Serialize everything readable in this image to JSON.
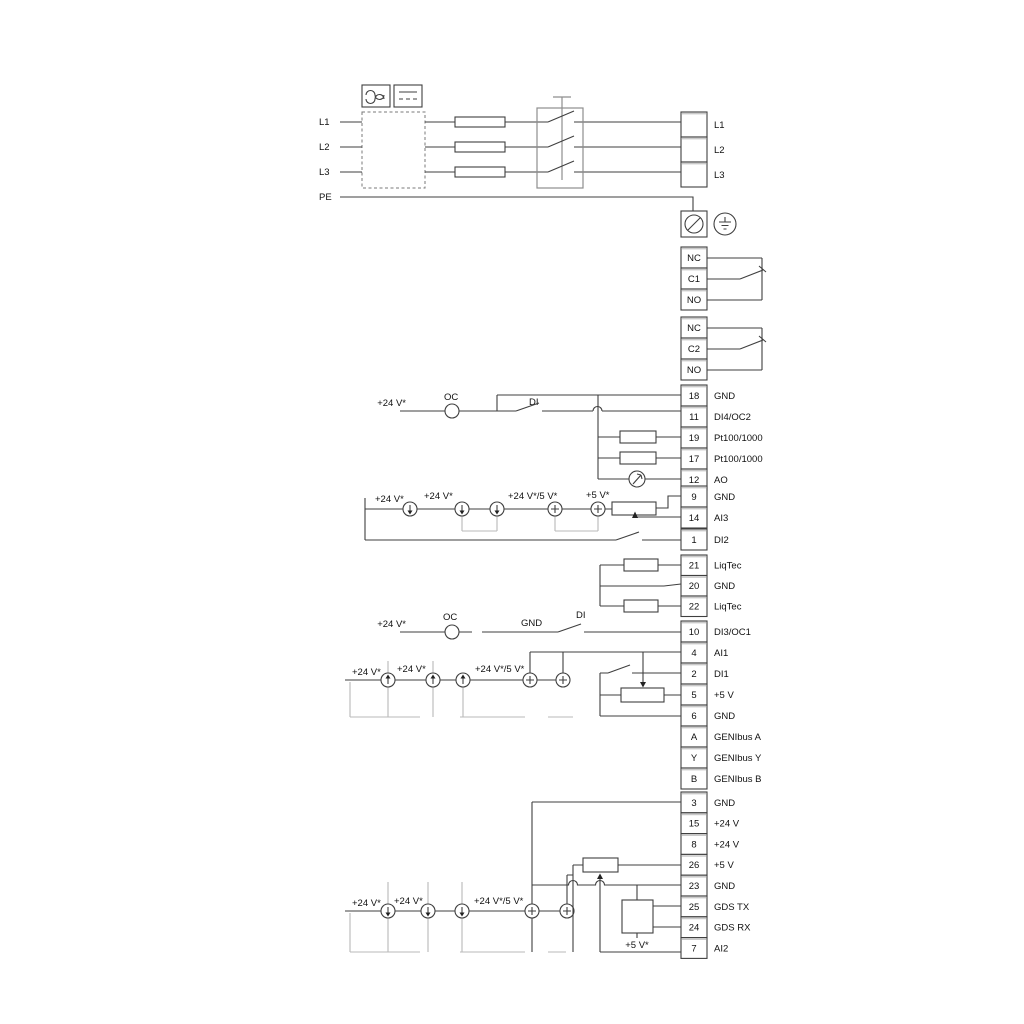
{
  "mains_in": {
    "l1": "L1",
    "l2": "L2",
    "l3": "L3",
    "pe": "PE"
  },
  "inline": {
    "v24": "+24 V*",
    "v24v5": "+24 V*/5 V*",
    "v5": "+5 V*",
    "oc": "OC",
    "di": "DI",
    "gnd": "GND"
  },
  "strips": {
    "mains_out": {
      "rows": [
        {
          "num": "",
          "label": "L1"
        },
        {
          "num": "",
          "label": "L2"
        },
        {
          "num": "",
          "label": "L3"
        }
      ]
    },
    "relay1": {
      "rows": [
        {
          "num": "NC",
          "label": ""
        },
        {
          "num": "C1",
          "label": ""
        },
        {
          "num": "NO",
          "label": ""
        }
      ]
    },
    "relay2": {
      "rows": [
        {
          "num": "NC",
          "label": ""
        },
        {
          "num": "C2",
          "label": ""
        },
        {
          "num": "NO",
          "label": ""
        }
      ]
    },
    "io_a": {
      "rows": [
        {
          "num": "18",
          "label": "GND"
        },
        {
          "num": "11",
          "label": "DI4/OC2"
        },
        {
          "num": "19",
          "label": "Pt100/1000"
        },
        {
          "num": "17",
          "label": "Pt100/1000"
        },
        {
          "num": "12",
          "label": "AO"
        }
      ]
    },
    "io_b": {
      "rows": [
        {
          "num": "9",
          "label": "GND"
        },
        {
          "num": "14",
          "label": "AI3"
        }
      ]
    },
    "io_c": {
      "rows": [
        {
          "num": "1",
          "label": "DI2"
        }
      ]
    },
    "liqtec": {
      "rows": [
        {
          "num": "21",
          "label": "LiqTec"
        },
        {
          "num": "20",
          "label": "GND"
        },
        {
          "num": "22",
          "label": "LiqTec"
        }
      ]
    },
    "di3": {
      "rows": [
        {
          "num": "10",
          "label": "DI3/OC1"
        }
      ]
    },
    "io_d": {
      "rows": [
        {
          "num": "4",
          "label": "AI1"
        },
        {
          "num": "2",
          "label": "DI1"
        },
        {
          "num": "5",
          "label": "+5 V"
        },
        {
          "num": "6",
          "label": "GND"
        },
        {
          "num": "A",
          "label": "GENIbus A"
        },
        {
          "num": "Y",
          "label": "GENIbus Y"
        },
        {
          "num": "B",
          "label": "GENIbus B"
        }
      ]
    },
    "io_e": {
      "rows": [
        {
          "num": "3",
          "label": "GND"
        },
        {
          "num": "15",
          "label": "+24 V"
        },
        {
          "num": "8",
          "label": "+24 V"
        },
        {
          "num": "26",
          "label": "+5 V"
        },
        {
          "num": "23",
          "label": "GND"
        },
        {
          "num": "25",
          "label": "GDS TX"
        },
        {
          "num": "24",
          "label": "GDS RX"
        },
        {
          "num": "7",
          "label": "AI2"
        }
      ]
    }
  },
  "icons": {
    "ac_supply": "ac-waveform-icon",
    "dc_supply": "dc-lines-icon",
    "pe_terminal": "circle-slash-icon",
    "earth": "earth-ground-icon",
    "current_source": "arrow-in-circle-icon",
    "voltage_source": "plus-in-circle-icon",
    "analog_output": "meter-needle-icon"
  },
  "colors": {
    "wire": "#3f3f3f",
    "gray_wire": "#8e8e8e",
    "option_box": "#b9b9b9",
    "text": "#111111",
    "background": "#ffffff"
  }
}
